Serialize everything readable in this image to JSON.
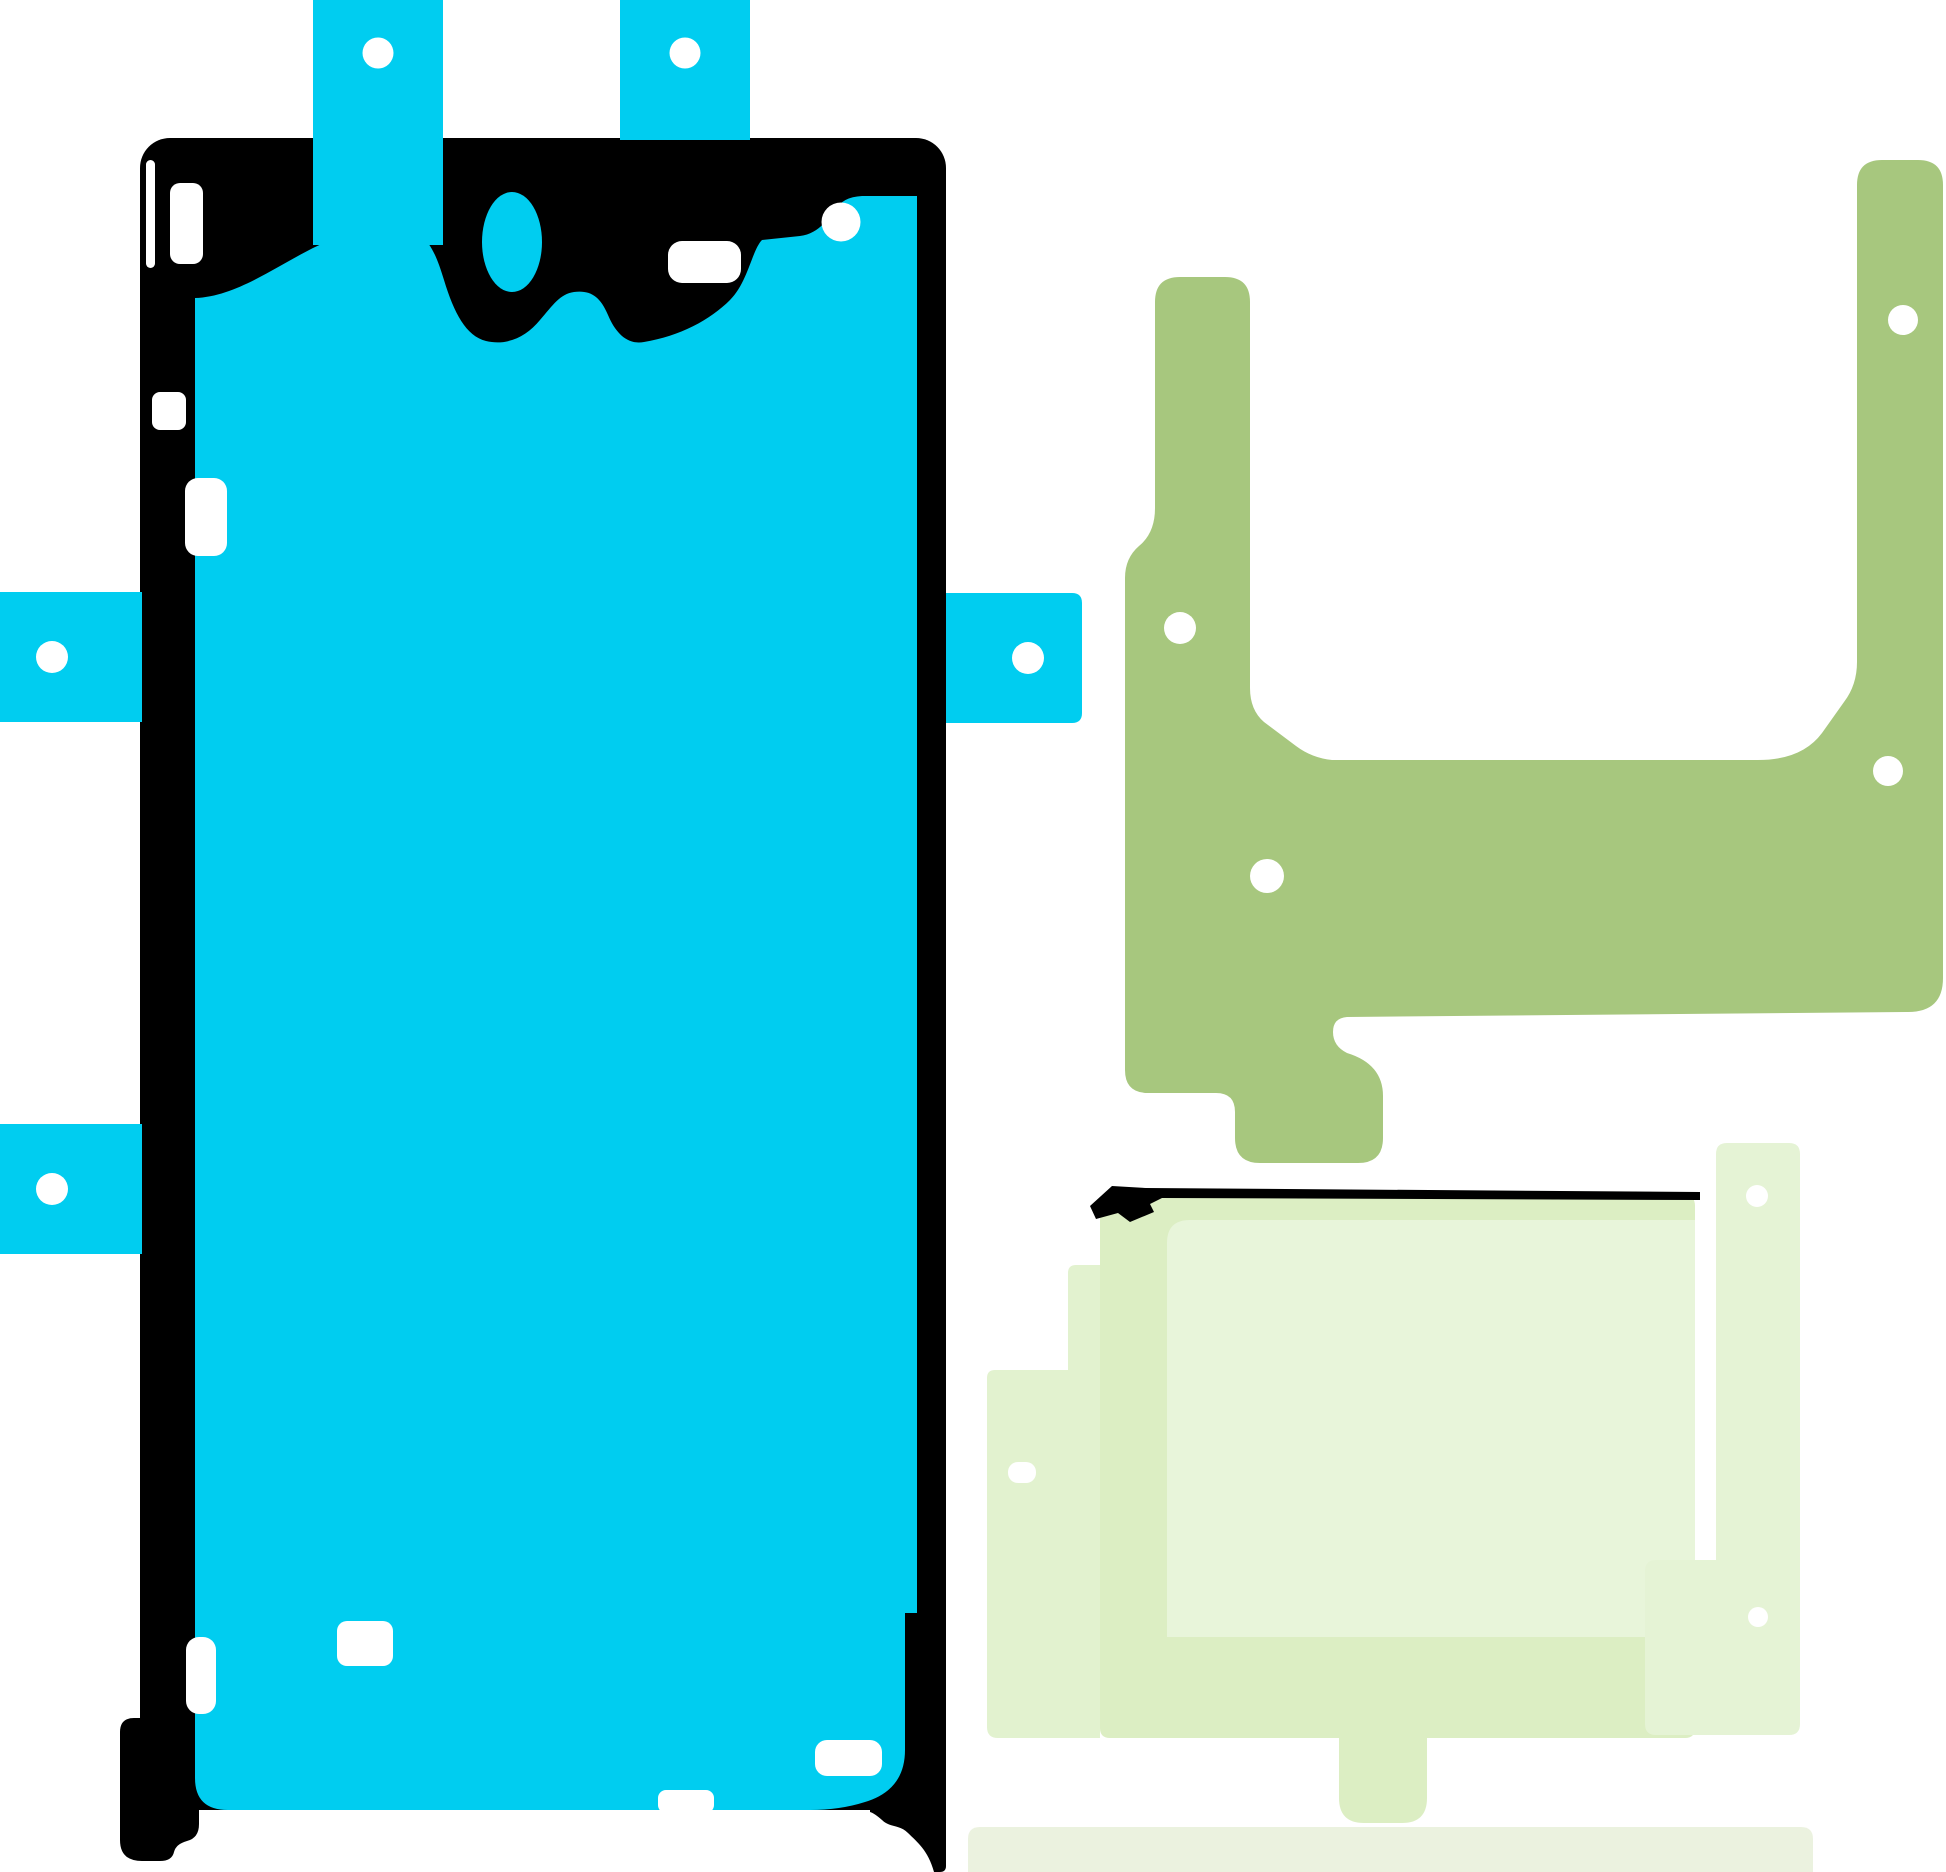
{
  "canvas": {
    "width": 1946,
    "height": 1872,
    "background": "#FFFFFF"
  },
  "colors": {
    "cyan": "#00CDF0",
    "black": "#000000",
    "olive": "#A7C77E",
    "paleA": "#DCEEC3",
    "paleB": "#E8F5DA",
    "paleC": "#E2F2CF",
    "paleE": "#E5F3D5",
    "strip": "#EBF2DF",
    "white": "#FFFFFF"
  },
  "parts": [
    {
      "name": "display-adhesive-frame",
      "type": "rect",
      "x": 140,
      "y": 138,
      "w": 806,
      "h": 1672,
      "rx": 30,
      "fill": "black"
    },
    {
      "name": "display-adhesive-corner-left",
      "type": "path",
      "fill": "black",
      "d": "M120,1732 Q120,1718 134,1718 L180,1718 L180,1782 Q180,1792 190,1795 Q199,1798 199,1810 L199,1824 Q199,1838 187,1841 Q176,1844 174,1852 Q172,1861 160,1861 L142,1861 Q120,1861 120,1840 Z"
    },
    {
      "name": "display-adhesive-corner-right",
      "type": "path",
      "fill": "black",
      "d": "M870,1812 L870,1790 Q870,1777 883,1777 L946,1777 L946,1866 Q946,1872 940,1872 L934,1872 C928,1850 917,1842 908,1833 C899,1824 890,1828 882,1820 Q874,1813 870,1812 Z"
    },
    {
      "name": "display-adhesive-inner",
      "type": "path",
      "fill": "cyan",
      "d": "M195,298 C250,296 302,243 350,235 L394,230 C424,228 433,244 444,280 C454,313 466,336 486,341 C507,346 526,337 540,320 C553,305 560,294 574,292 C590,290 600,296 608,315 C616,334 628,345 644,342 C680,336 710,320 730,300 C748,282 752,250 762,240 L800,236 C820,234 830,215 836,210 Q842,197 862,196 L917,196 L917,1613 L905,1613 L905,1750 Q905,1790 865,1802 Q840,1810 810,1810 L228,1810 Q195,1810 195,1778 Z"
    },
    {
      "name": "display-adhesive-tab-top-left",
      "type": "rect",
      "x": 313,
      "y": 0,
      "w": 130,
      "h": 245,
      "rx": 0,
      "fill": "cyan"
    },
    {
      "name": "display-adhesive-tab-top-right",
      "type": "rect",
      "x": 620,
      "y": 0,
      "w": 130,
      "h": 140,
      "rx": 0,
      "fill": "cyan"
    },
    {
      "name": "display-adhesive-tab-left-upper",
      "type": "rect",
      "x": 0,
      "y": 592,
      "w": 142,
      "h": 130,
      "rx": 0,
      "fill": "cyan"
    },
    {
      "name": "display-adhesive-tab-left-lower",
      "type": "rect",
      "x": 0,
      "y": 1124,
      "w": 142,
      "h": 130,
      "rx": 0,
      "fill": "cyan"
    },
    {
      "name": "display-adhesive-tab-right",
      "type": "path",
      "fill": "cyan",
      "d": "M946,593 L1072,593 Q1082,593 1082,603 L1082,713 Q1082,723 1072,723 L946,723 Z"
    },
    {
      "name": "front-camera-cutout",
      "type": "ellipse",
      "cx": 512,
      "cy": 242,
      "rx": 30,
      "ry": 50,
      "fill": "cyan"
    },
    {
      "name": "punch-hole-tab-top-left",
      "type": "circle",
      "cx": 378,
      "cy": 53,
      "r": 15.5,
      "fill": "white"
    },
    {
      "name": "punch-hole-tab-top-right",
      "type": "circle",
      "cx": 685,
      "cy": 53,
      "r": 15.5,
      "fill": "white"
    },
    {
      "name": "punch-hole-tab-left-upper",
      "type": "circle",
      "cx": 52,
      "cy": 657,
      "r": 16,
      "fill": "white"
    },
    {
      "name": "punch-hole-tab-left-lower",
      "type": "circle",
      "cx": 52,
      "cy": 1189,
      "r": 16,
      "fill": "white"
    },
    {
      "name": "punch-hole-tab-right",
      "type": "circle",
      "cx": 1028,
      "cy": 658,
      "r": 16,
      "fill": "white"
    },
    {
      "name": "cutout-left-edge-slot",
      "type": "rect",
      "x": 146,
      "y": 160,
      "w": 9,
      "h": 108,
      "rx": 4.5,
      "fill": "white"
    },
    {
      "name": "cutout-top-left",
      "type": "rect",
      "x": 170,
      "y": 183,
      "w": 33,
      "h": 81,
      "rx": 10,
      "fill": "white"
    },
    {
      "name": "cutout-sensor",
      "type": "rect",
      "x": 668,
      "y": 241,
      "w": 73,
      "h": 42,
      "rx": 14,
      "fill": "white"
    },
    {
      "name": "punch-hole-top-right",
      "type": "circle",
      "cx": 841,
      "cy": 222,
      "r": 19.5,
      "fill": "white"
    },
    {
      "name": "cutout-left-mid-small",
      "type": "rect",
      "x": 152,
      "y": 392,
      "w": 34,
      "h": 38,
      "rx": 8,
      "fill": "white"
    },
    {
      "name": "cutout-left-mid-slot",
      "type": "rect",
      "x": 185,
      "y": 478,
      "w": 42,
      "h": 78,
      "rx": 13,
      "fill": "white"
    },
    {
      "name": "cutout-bottom-left-slot",
      "type": "rect",
      "x": 186,
      "y": 1637,
      "w": 30,
      "h": 77,
      "rx": 13,
      "fill": "white"
    },
    {
      "name": "cutout-bottom-left-rect",
      "type": "rect",
      "x": 337,
      "y": 1621,
      "w": 56,
      "h": 45,
      "rx": 10,
      "fill": "white"
    },
    {
      "name": "cutout-bottom-right-rect",
      "type": "rect",
      "x": 815,
      "y": 1740,
      "w": 67,
      "h": 36,
      "rx": 12,
      "fill": "white"
    },
    {
      "name": "cutout-bottom-center",
      "type": "rect",
      "x": 658,
      "y": 1790,
      "w": 56,
      "h": 23,
      "rx": 8,
      "fill": "white"
    },
    {
      "name": "battery-adhesive-bracket",
      "type": "path",
      "fill": "olive",
      "d": "M1155,302 Q1155,277 1180,277 L1225,277 Q1250,277 1250,302 L1250,688 Q1250,710 1264,722 L1296,746 Q1312,758 1332,760 L1758,760 Q1802,760 1822,733 L1844,702 Q1857,685 1857,662 L1857,185 Q1857,160 1882,160 L1918,160 Q1943,160 1943,185 L1943,978 Q1943,1012 1908,1012 L1347,1017 Q1333,1018 1333,1032 Q1333,1046 1347,1053 Q1383,1064 1383,1096 L1383,1138 Q1383,1163 1358,1163 L1260,1163 Q1235,1163 1235,1138 L1235,1112 Q1235,1093 1216,1093 L1148,1093 Q1125,1093 1125,1070 L1125,578 Q1125,558 1139,546 Q1155,533 1155,508 Z"
    },
    {
      "name": "punch-hole-bracket-arm-left",
      "type": "circle",
      "cx": 1180,
      "cy": 628,
      "r": 16,
      "fill": "white"
    },
    {
      "name": "punch-hole-bracket-body",
      "type": "circle",
      "cx": 1267,
      "cy": 876,
      "r": 17,
      "fill": "white"
    },
    {
      "name": "punch-hole-bracket-arm-right",
      "type": "circle",
      "cx": 1903,
      "cy": 320,
      "r": 15,
      "fill": "white"
    },
    {
      "name": "punch-hole-bracket-right",
      "type": "circle",
      "cx": 1888,
      "cy": 771,
      "r": 15,
      "fill": "white"
    },
    {
      "name": "rear-adhesive-sheet-left",
      "type": "path",
      "fill": "paleC",
      "d": "M1100,1265 L1076,1265 Q1068,1265 1068,1273 L1068,1370 L995,1370 Q987,1370 987,1378 L987,1727 Q987,1738 998,1738 L1100,1738 Z"
    },
    {
      "name": "rear-adhesive-sheet-main",
      "type": "path",
      "fill": "paleA",
      "d": "M1100,1208 Q1100,1196 1112,1196 L1686,1196 Q1695,1196 1695,1206 L1695,1728 Q1695,1738 1685,1738 L1110,1738 Q1100,1738 1100,1728 Z"
    },
    {
      "name": "rear-adhesive-sheet-top",
      "type": "path",
      "fill": "paleB",
      "d": "M1167,1243 Q1167,1220 1190,1220 L1695,1220 L1695,1637 L1167,1637 Z"
    },
    {
      "name": "rear-adhesive-strip-right",
      "type": "path",
      "fill": "paleE",
      "d": "M1716,1154 Q1716,1143 1727,1143 L1789,1143 Q1800,1143 1800,1154 L1800,1724 Q1800,1735 1789,1735 L1656,1735 Q1645,1735 1645,1724 L1645,1571 Q1645,1560 1656,1560 L1716,1560 Z"
    },
    {
      "name": "rear-adhesive-tape-line",
      "type": "path",
      "fill": "black",
      "d": "M1090,1206 L1112,1186 L1146,1188 L1700,1192 L1700,1200 L1162,1198 L1150,1204 L1154,1212 L1130,1222 L1118,1213 L1096,1219 Z"
    },
    {
      "name": "rear-adhesive-tab-bottom",
      "type": "path",
      "fill": "paleA",
      "d": "M1339,1738 L1427,1738 L1427,1798 Q1427,1823 1402,1823 L1364,1823 Q1339,1823 1339,1798 Z"
    },
    {
      "name": "rear-adhesive-strip-bottom",
      "type": "path",
      "fill": "strip",
      "d": "M968,1839 Q968,1827 980,1827 L1801,1827 Q1813,1827 1813,1839 L1813,1872 L968,1872 Z"
    },
    {
      "name": "punch-hole-strip-top",
      "type": "circle",
      "cx": 1757,
      "cy": 1196,
      "r": 11,
      "fill": "white"
    },
    {
      "name": "punch-hole-strip-mid",
      "type": "circle",
      "cx": 1758,
      "cy": 1617,
      "r": 10,
      "fill": "white"
    },
    {
      "name": "punch-hole-sheet-left",
      "type": "rect",
      "x": 1008,
      "y": 1462,
      "w": 28,
      "h": 21,
      "rx": 10,
      "fill": "white"
    }
  ]
}
